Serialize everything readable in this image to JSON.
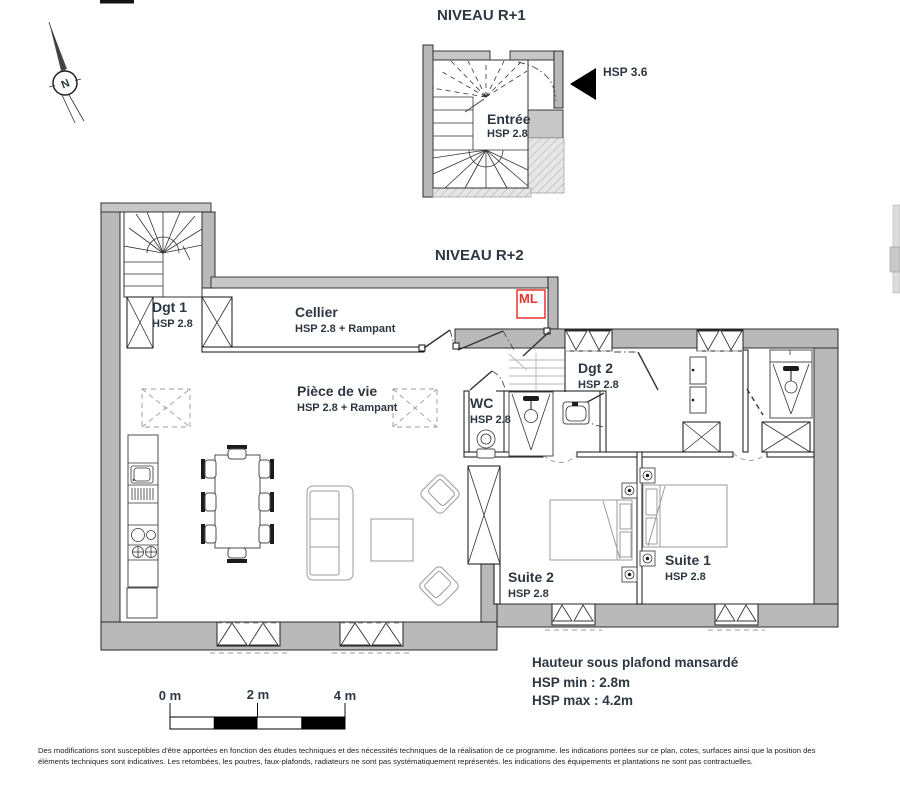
{
  "r1": {
    "title": "NIVEAU R+1",
    "entree": {
      "name": "Entrée",
      "hsp": "HSP 2.8"
    },
    "hsp_pointer": "HSP 3.6"
  },
  "r2": {
    "title": "NIVEAU R+2",
    "ml_label": "ML",
    "rooms": {
      "dgt1": {
        "name": "Dgt 1",
        "hsp": "HSP 2.8"
      },
      "cellier": {
        "name": "Cellier",
        "hsp": "HSP 2.8 + Rampant"
      },
      "piece": {
        "name": "Pièce de vie",
        "hsp": "HSP 2.8 + Rampant"
      },
      "wc": {
        "name": "WC",
        "hsp": "HSP 2.8"
      },
      "dgt2": {
        "name": "Dgt 2",
        "hsp": "HSP 2.8"
      },
      "suite2": {
        "name": "Suite 2",
        "hsp": "HSP 2.8"
      },
      "suite1": {
        "name": "Suite 1",
        "hsp": "HSP 2.8"
      }
    }
  },
  "ceiling_note": {
    "line1": "Hauteur sous plafond mansardé",
    "line2": "HSP min : 2.8m",
    "line3": "HSP max : 4.2m"
  },
  "scale_bar": {
    "t0": "0 m",
    "t2": "2 m",
    "t4": "4 m"
  },
  "north": {
    "label": "N"
  },
  "footer": {
    "line1": "Des modifications sont susceptibles d'être apportées en fonction des études techniques et des nécessités techniques de la réalisation de ce programme. les indications portées sur ce plan, cotes, surfaces ainsi que la position des",
    "line2": "éléments techniques sont indicatives. Les retombées, les poutres, faux-plafonds, radiateurs ne sont pas systématiquement représentés. les indications des équipements et plantations ne sont pas contractuelles."
  },
  "colors": {
    "wall_gray": "#b9b9b9",
    "wall_light_gray": "#c7c7c7",
    "accent_red": "#e7352e",
    "text": "#2d3742"
  }
}
